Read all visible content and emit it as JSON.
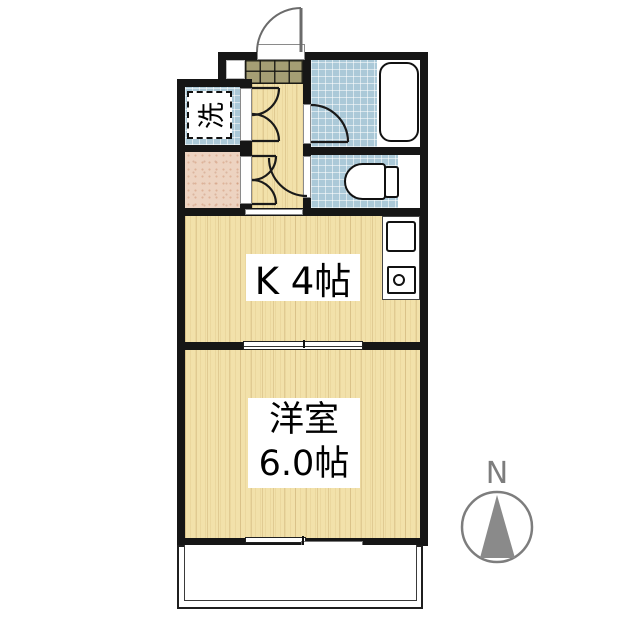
{
  "plan": {
    "type": "japanese-apartment-floor-plan",
    "labels": {
      "kitchen": "K 4帖",
      "room_line1": "洋室",
      "room_line2": "6.0帖",
      "washing_machine": "洗",
      "compass_north": "N"
    },
    "areas": [
      {
        "name": "entrance-genkan"
      },
      {
        "name": "hallway"
      },
      {
        "name": "washing-machine-space",
        "label": "洗"
      },
      {
        "name": "storage-closet"
      },
      {
        "name": "unit-bath-with-tub"
      },
      {
        "name": "toilet-room"
      },
      {
        "name": "kitchen",
        "label": "K 4帖"
      },
      {
        "name": "western-room",
        "label": "洋室 6.0帖"
      },
      {
        "name": "balcony"
      }
    ],
    "colors": {
      "wall": "#161616",
      "wood_floor": "#f2e1aa",
      "tile_blue": "#abc9d8",
      "genkan_tile": "#a59e74",
      "closet_floor": "#edd3c1",
      "compass_gray": "#7d7d7d",
      "door_gray": "#6b6b6b"
    }
  }
}
